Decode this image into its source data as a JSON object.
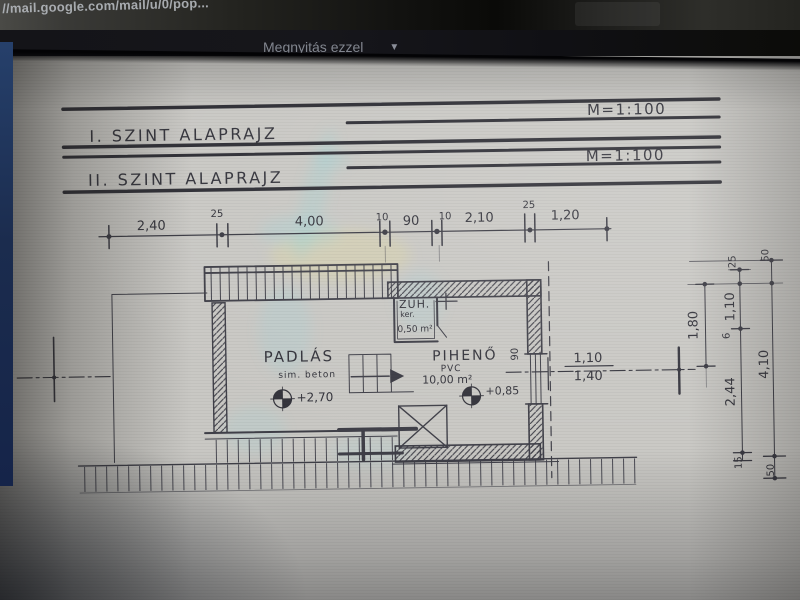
{
  "browser": {
    "url": "//mail.google.com/mail/u/0/pop..."
  },
  "toolbar": {
    "open_with_label": "Megnyitás ezzel",
    "chevron": "▼"
  },
  "drawing": {
    "titles": [
      {
        "label": "I. SZINT ALAPRAJZ",
        "scale": "M=1:100"
      },
      {
        "label": "II. SZINT ALAPRAJZ",
        "scale": "M=1:100"
      }
    ],
    "top_dims": [
      "2,40",
      "25",
      "4,00",
      "10",
      "90",
      "10",
      "2,10",
      "25",
      "1,20"
    ],
    "right_dims": [
      "25",
      "50",
      "1,80",
      "1,10",
      "6",
      "2,44",
      "4,10",
      "15",
      "50"
    ],
    "window_dim": {
      "w": "1,10",
      "h": "1,40"
    },
    "wall_opening": "90",
    "rooms": [
      {
        "name": "PADLÁS",
        "finish": "sim. beton",
        "level": "+2,70"
      },
      {
        "name": "PIHENŐ",
        "finish": "PVC",
        "area": "10,00 m²",
        "level": "+0,85"
      },
      {
        "name": "ZUH.",
        "finish": "ker.",
        "area": "0,50 m²"
      }
    ],
    "ink": "#3a3a43"
  }
}
